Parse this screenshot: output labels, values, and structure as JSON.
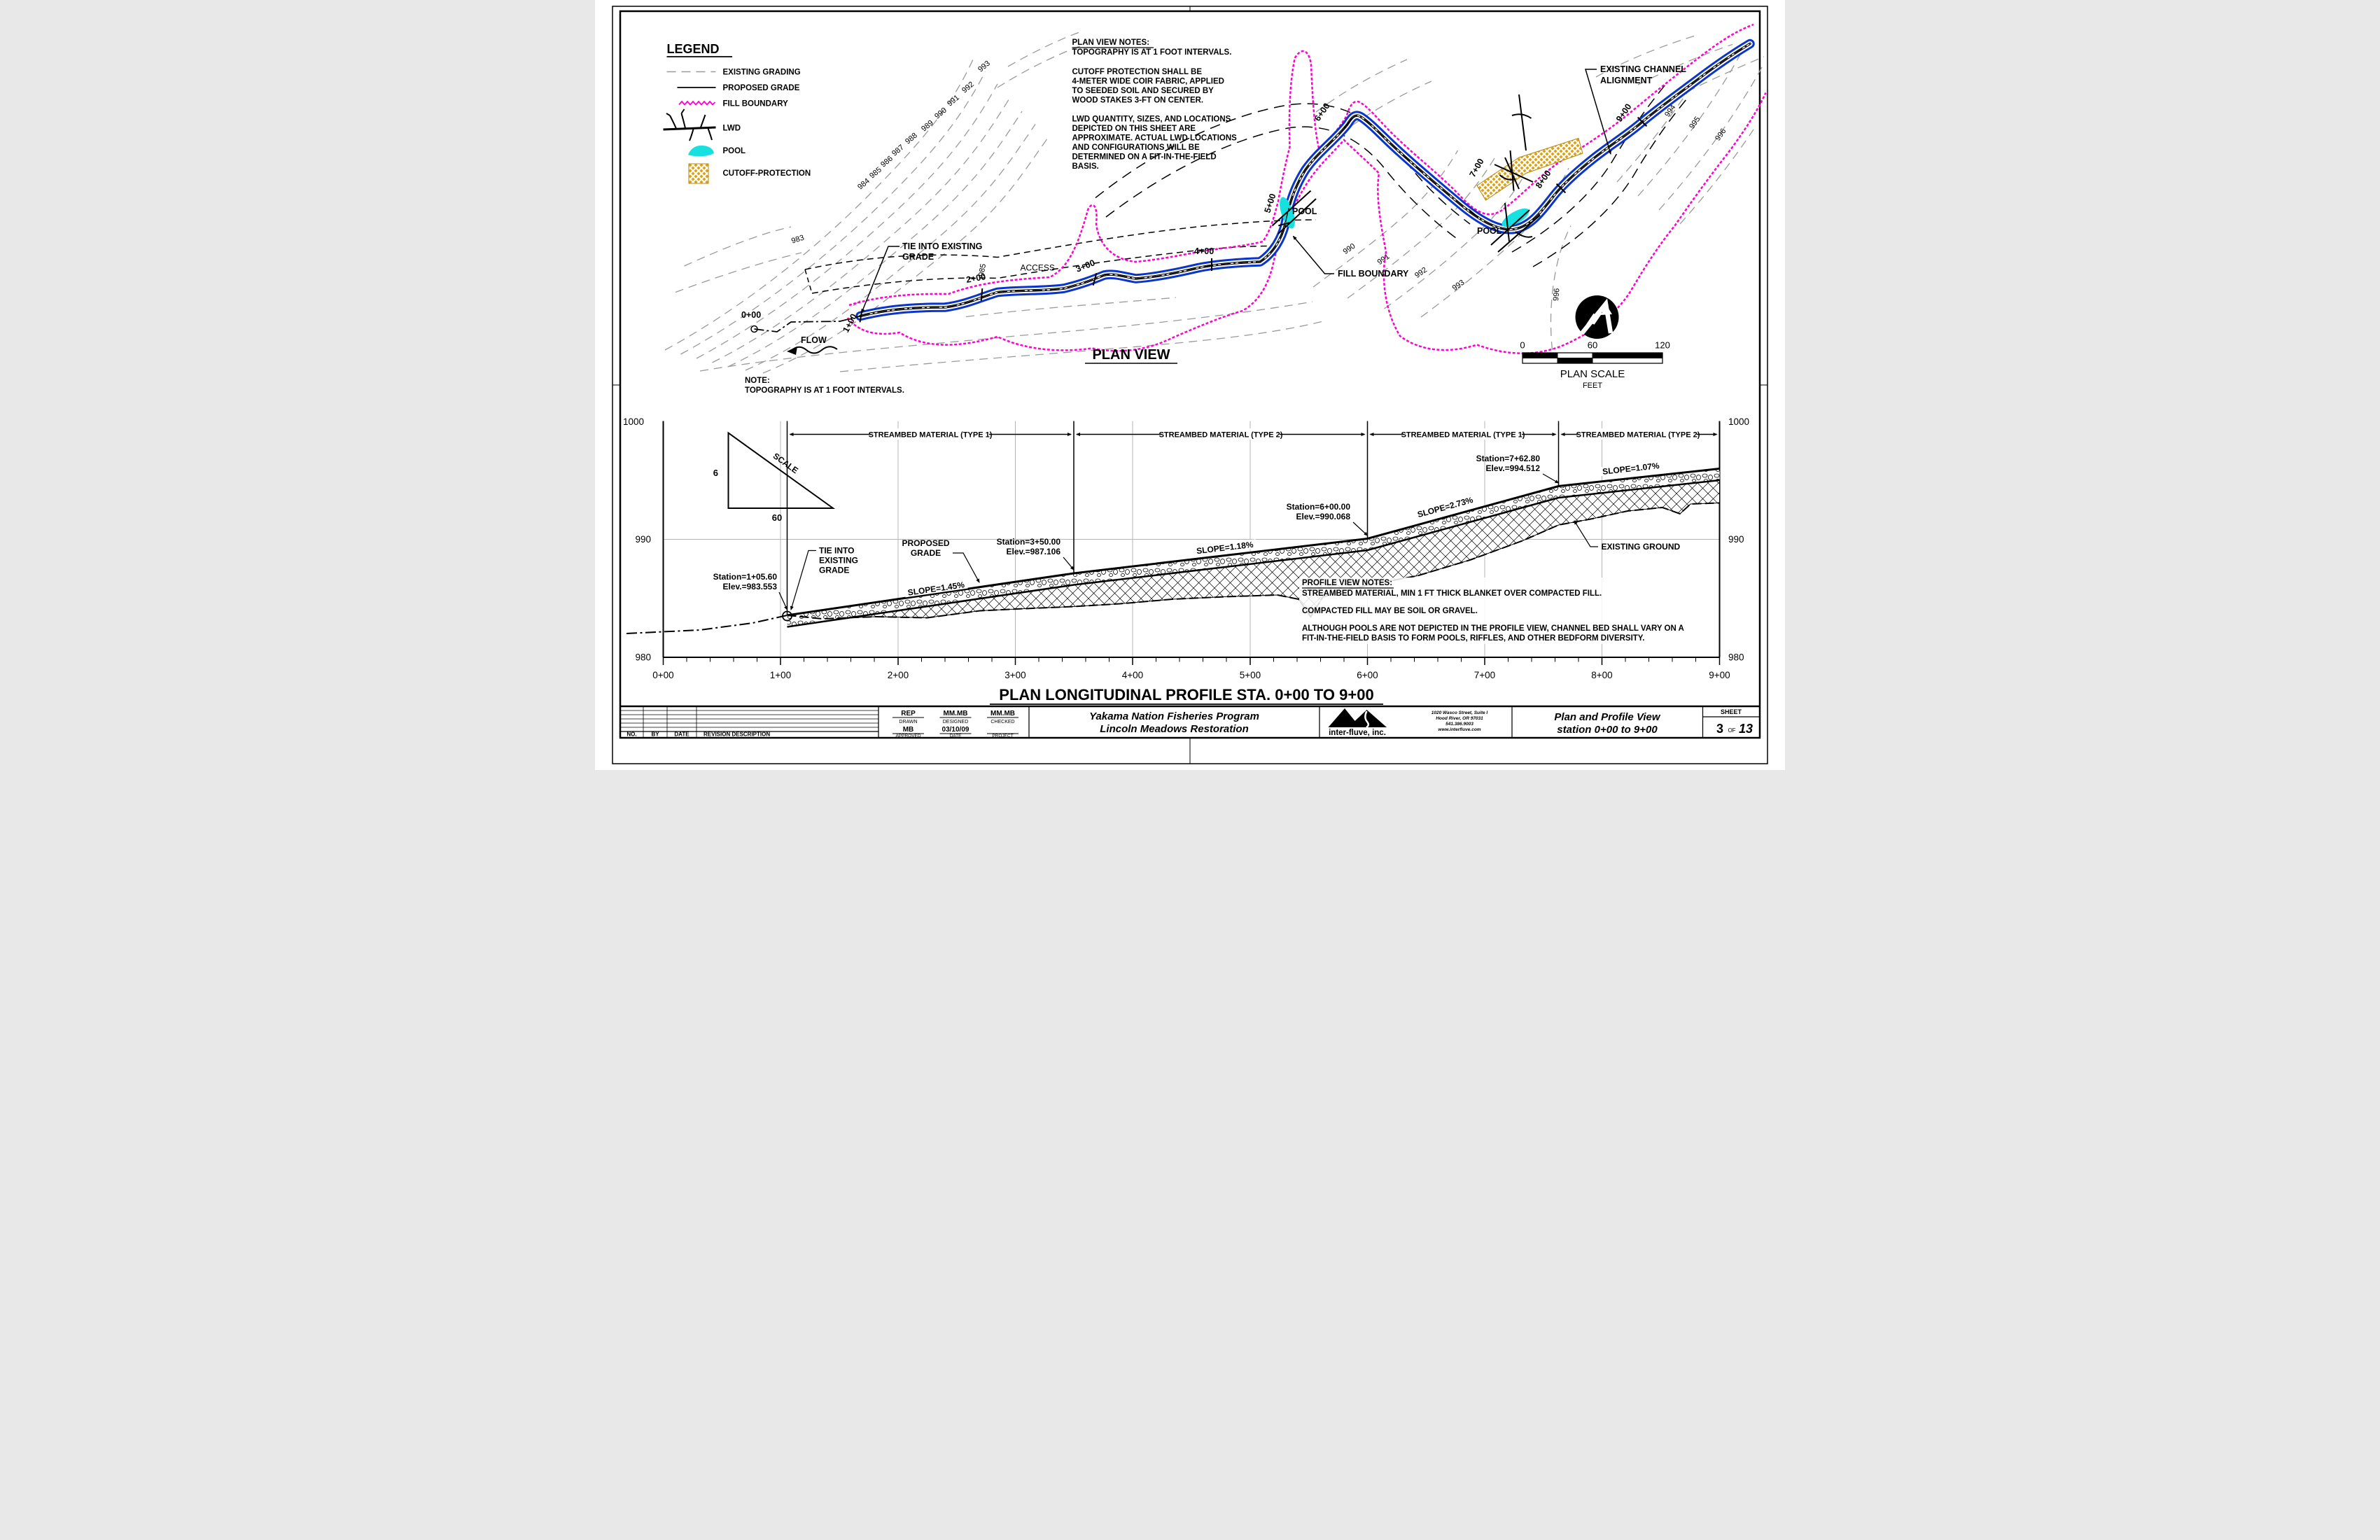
{
  "colors": {
    "channel_blue": "#0a35cc",
    "fill_boundary_magenta": "#ff00d0",
    "pool_cyan": "#17e0e0",
    "cutoff_gold": "#d8a31d",
    "contour_gray": "#9a9a9a"
  },
  "legend": {
    "title": "LEGEND",
    "items": [
      {
        "label": "EXISTING GRADING"
      },
      {
        "label": "PROPOSED GRADE"
      },
      {
        "label": "FILL BOUNDARY"
      },
      {
        "label": "LWD"
      },
      {
        "label": "POOL"
      },
      {
        "label": "CUTOFF-PROTECTION"
      }
    ]
  },
  "plan_notes": {
    "lines": [
      "PLAN VIEW NOTES:",
      "TOPOGRAPHY IS AT 1 FOOT INTERVALS.",
      "CUTOFF PROTECTION SHALL BE",
      "4-METER WIDE COIR FABRIC, APPLIED",
      "TO SEEDED SOIL AND SECURED BY",
      "WOOD STAKES 3-FT ON CENTER.",
      "LWD QUANTITY, SIZES, AND LOCATIONS",
      "DEPICTED ON THIS SHEET ARE",
      "APPROXIMATE. ACTUAL LWD LOCATIONS",
      "AND CONFIGURATIONS WILL BE",
      "DETERMINED ON A FIT-IN-THE-FIELD",
      "BASIS."
    ]
  },
  "stations": [
    "0+00",
    "1+00",
    "2+00",
    "3+00",
    "4+00",
    "5+00",
    "6+00",
    "7+00",
    "8+00",
    "9+00"
  ],
  "plan": {
    "title": "PLAN VIEW",
    "note_l1": "NOTE:",
    "note_l2": "TOPOGRAPHY IS AT 1 FOOT INTERVALS.",
    "flow": "FLOW",
    "access": "ACCESS",
    "tie_l1": "TIE INTO EXISTING",
    "tie_l2": "GRADE",
    "fill_boundary": "FILL BOUNDARY",
    "pool1": "POOL",
    "pool2": "POOL",
    "exist_align_l1": "EXISTING CHANNEL",
    "exist_align_l2": "ALIGNMENT",
    "contours": [
      "993",
      "992",
      "991",
      "990",
      "989",
      "988",
      "987",
      "986",
      "985",
      "984",
      "983",
      "985",
      "990",
      "991",
      "992",
      "993",
      "994",
      "995",
      "996",
      "996"
    ],
    "scale": {
      "t0": "0",
      "t60": "60",
      "t120": "120",
      "title": "PLAN SCALE",
      "unit": "FEET"
    }
  },
  "profile": {
    "title": "PLAN LONGITUDINAL PROFILE STA. 0+00 TO 9+00",
    "elevs": [
      "1000",
      "990",
      "980"
    ],
    "zones": [
      "STREAMBED MATERIAL (TYPE 1)",
      "STREAMBED MATERIAL (TYPE 2)",
      "STREAMBED MATERIAL (TYPE 1)",
      "STREAMBED MATERIAL (TYPE 2)"
    ],
    "callouts": {
      "sta1": {
        "l1": "Station=1+05.60",
        "l2": "Elev.=983.553"
      },
      "sta35": {
        "l1": "Station=3+50.00",
        "l2": "Elev.=987.106"
      },
      "sta6": {
        "l1": "Station=6+00.00",
        "l2": "Elev.=990.068"
      },
      "sta76": {
        "l1": "Station=7+62.80",
        "l2": "Elev.=994.512"
      }
    },
    "tie": [
      "TIE INTO",
      "EXISTING",
      "GRADE"
    ],
    "proposed": [
      "PROPOSED",
      "GRADE"
    ],
    "slopes": [
      "SLOPE=1.45%",
      "SLOPE=1.18%",
      "SLOPE=2.73%",
      "SLOPE=1.07%"
    ],
    "existing_ground": "EXISTING GROUND",
    "notes": [
      "PROFILE VIEW NOTES:",
      "STREAMBED MATERIAL, MIN 1 FT THICK BLANKET OVER COMPACTED FILL.",
      "COMPACTED FILL MAY BE SOIL OR GRAVEL.",
      "ALTHOUGH POOLS ARE NOT DEPICTED IN THE PROFILE VIEW, CHANNEL BED SHALL VARY ON A",
      "FIT-IN-THE-FIELD BASIS TO FORM POOLS, RIFFLES, AND OTHER BEDFORM DIVERSITY."
    ],
    "scale_tri": {
      "v": "6",
      "h": "60",
      "label": "SCALE"
    }
  },
  "titleblock": {
    "rev": {
      "no": "NO.",
      "by": "BY",
      "date": "DATE",
      "desc": "REVISION DESCRIPTION"
    },
    "drawn": {
      "v": "REP",
      "l": "DRAWN"
    },
    "designed": {
      "v": "MM.MB",
      "l": "DESIGNED"
    },
    "checked": {
      "v": "MM.MB",
      "l": "CHECKED"
    },
    "approved": {
      "v": "MB",
      "l": "APPROVED"
    },
    "date": {
      "v": "03/10/09",
      "l": "DATE"
    },
    "project": {
      "v": "",
      "l": "PROJECT"
    },
    "client_l1": "Yakama Nation Fisheries Program",
    "client_l2": "Lincoln Meadows Restoration",
    "firm": {
      "name": "inter-fluve, inc.",
      "addr": [
        "1020 Wasco Street, Suite I",
        "Hood River, OR 97031",
        "541.386.9003",
        "www.interfluve.com"
      ]
    },
    "sheet_title_l1": "Plan and Profile View",
    "sheet_title_l2": "station 0+00 to 9+00",
    "sheet": {
      "label": "SHEET",
      "num": "3",
      "of": "OF",
      "total": "13"
    }
  }
}
